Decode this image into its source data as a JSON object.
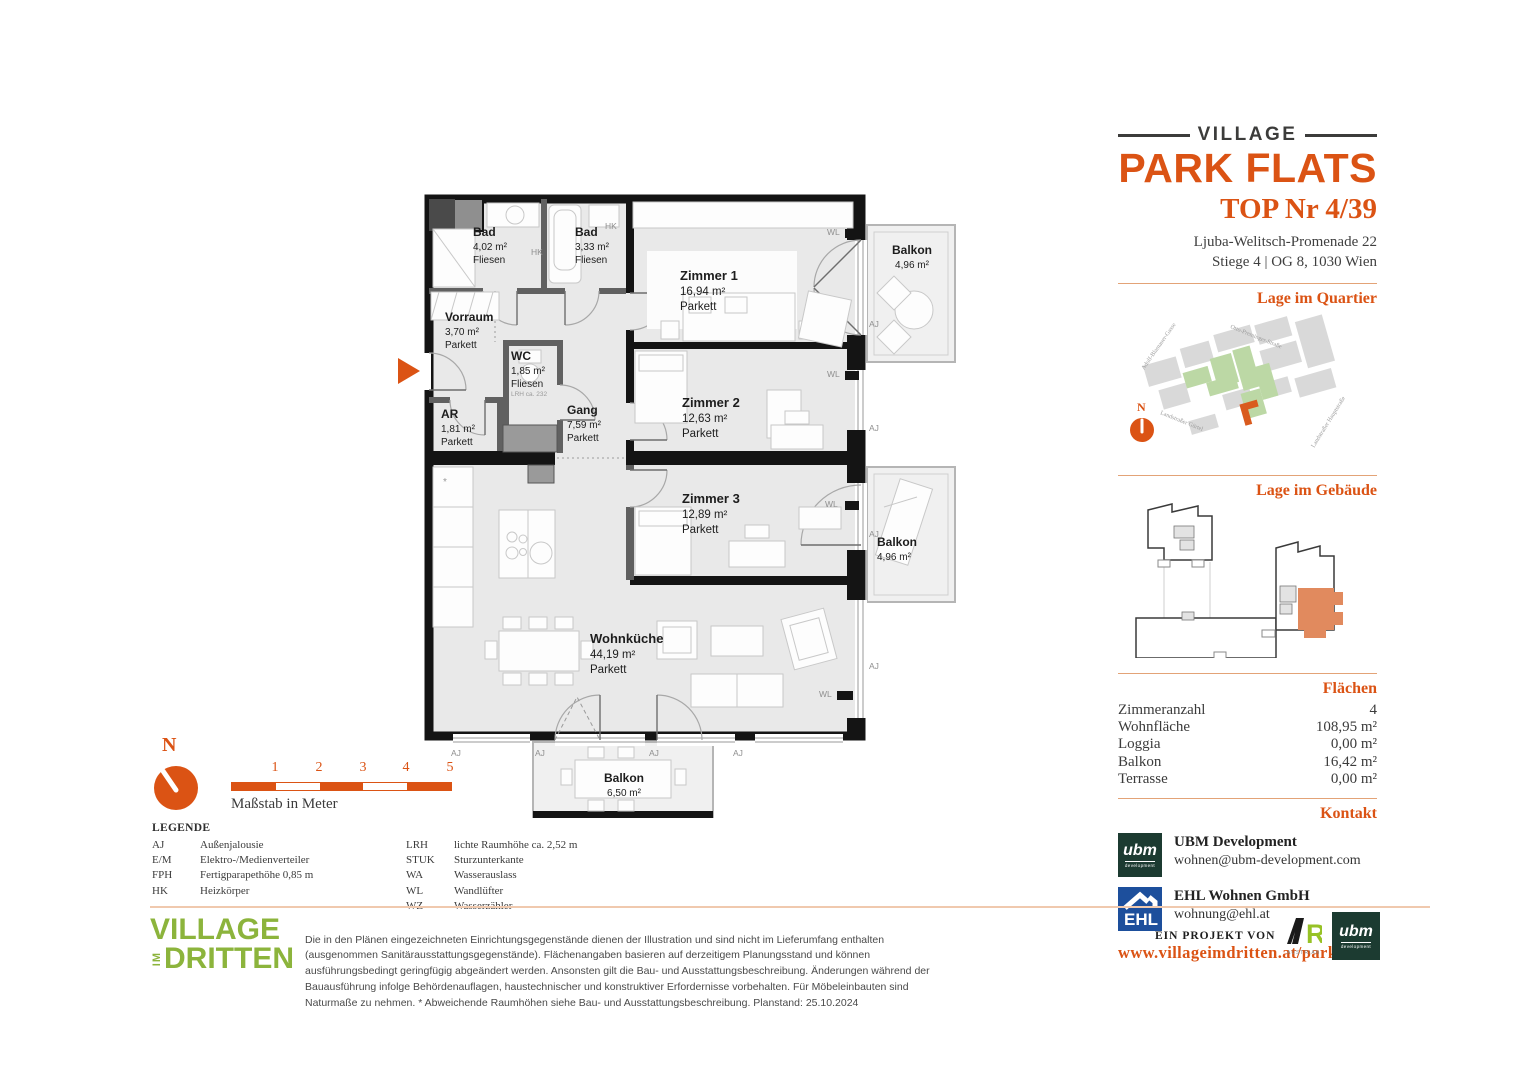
{
  "header": {
    "brand_top": "VILLAGE",
    "brand_main": "PARK FLATS",
    "unit_title": "TOP Nr 4/39",
    "address_line1": "Ljuba-Welitsch-Promenade 22",
    "address_line2": "Stiege 4 | OG 8, 1030 Wien"
  },
  "sections": {
    "quartier": "Lage im Quartier",
    "gebaeude": "Lage im Gebäude",
    "flaechen": "Flächen",
    "kontakt": "Kontakt"
  },
  "map": {
    "north": "N",
    "streets": [
      "Adolf-Blamauer-Gasse",
      "Otto-Preminger-Straße",
      "Landstraßer Gürtel",
      "Landstraßer Hauptstraße"
    ]
  },
  "areas": {
    "rows": [
      {
        "label": "Zimmeranzahl",
        "value": "4"
      },
      {
        "label": "Wohnfläche",
        "value": "108,95 m²"
      },
      {
        "label": "Loggia",
        "value": "0,00 m²"
      },
      {
        "label": "Balkon",
        "value": "16,42 m²"
      },
      {
        "label": "Terrasse",
        "value": "0,00 m²"
      }
    ]
  },
  "contact": {
    "ubm_logo_text": "ubm",
    "ubm_logo_sub": "development",
    "ubm_name": "UBM Development",
    "ubm_email": "wohnen@ubm-development.com",
    "ehl_logo_text": "EHL",
    "ehl_name": "EHL Wohnen GmbH",
    "ehl_email": "wohnung@ehl.at",
    "website": "www.villageimdritten.at/parkflats"
  },
  "plan": {
    "rooms": [
      {
        "name": "Bad",
        "area": "4,02 m²",
        "floor": "Fliesen"
      },
      {
        "name": "Bad",
        "area": "3,33 m²",
        "floor": "Fliesen"
      },
      {
        "name": "Zimmer 1",
        "area": "16,94 m²",
        "floor": "Parkett"
      },
      {
        "name": "Vorraum",
        "area": "3,70 m²",
        "floor": "Parkett"
      },
      {
        "name": "WC",
        "area": "1,85 m²",
        "floor": "Fliesen",
        "note": "LRH ca. 232"
      },
      {
        "name": "AR",
        "area": "1,81 m²",
        "floor": "Parkett"
      },
      {
        "name": "Gang",
        "area": "7,59 m²",
        "floor": "Parkett"
      },
      {
        "name": "Zimmer 2",
        "area": "12,63 m²",
        "floor": "Parkett"
      },
      {
        "name": "Zimmer 3",
        "area": "12,89 m²",
        "floor": "Parkett"
      },
      {
        "name": "Wohnküche",
        "area": "44,19 m²",
        "floor": "Parkett"
      },
      {
        "name": "Balkon",
        "area": "4,96 m²"
      },
      {
        "name": "Balkon",
        "area": "4,96 m²"
      },
      {
        "name": "Balkon",
        "area": "6,50 m²"
      }
    ],
    "annotations": [
      "HK",
      "HK",
      "WL",
      "WL",
      "WL",
      "WL",
      "AJ",
      "AJ",
      "AJ",
      "AJ",
      "AJ",
      "AJ",
      "AJ",
      "AJ"
    ]
  },
  "scalebar": {
    "north": "N",
    "ticks": [
      "1",
      "2",
      "3",
      "4",
      "5"
    ],
    "caption": "Maßstab in Meter"
  },
  "legend": {
    "title": "LEGENDE",
    "col1": [
      {
        "abbr": "AJ",
        "text": "Außenjalousie"
      },
      {
        "abbr": "E/M",
        "text": "Elektro-/Medienverteiler"
      },
      {
        "abbr": "FPH",
        "text": "Fertigparapethöhe 0,85 m"
      },
      {
        "abbr": "HK",
        "text": "Heizkörper"
      }
    ],
    "col2": [
      {
        "abbr": "LRH",
        "text": "lichte Raumhöhe ca. 2,52 m"
      },
      {
        "abbr": "STUK",
        "text": "Sturzunterkante"
      },
      {
        "abbr": "WA",
        "text": "Wasserauslass"
      },
      {
        "abbr": "WL",
        "text": "Wandlüfter"
      },
      {
        "abbr": "WZ",
        "text": "Wasserzähler"
      }
    ]
  },
  "footer": {
    "logo_line1": "VILLAGE",
    "logo_im": "IM",
    "logo_line2": "DRITTEN",
    "disclaimer": "Die in den Plänen eingezeichneten Einrichtungsgegenstände dienen der Illustration und sind nicht im Lieferumfang enthalten (ausgenommen Sanitärausstattungsgegenstände). Flächenangaben basieren auf derzeitigem Planungsstand und können ausführungsbedingt geringfügig abgeändert werden. Ansonsten gilt die Bau- und Ausstattungsbeschreibung. Änderungen während der Bauausführung infolge Behördenauflagen, haustechnischer und konstruktiver Erfordernisse vorbehalten. Für Möbeleinbauten sind Naturmaße zu nehmen. * Abweichende Raumhöhen siehe Bau- und Ausstattungsbeschreibung. Planstand: 25.10.2024",
    "project_label": "EIN PROJEKT VON",
    "are_text": "RE",
    "are_sub": "AUSTRIAN REAL ESTATE",
    "ubm_text": "ubm",
    "ubm_sub": "development"
  }
}
